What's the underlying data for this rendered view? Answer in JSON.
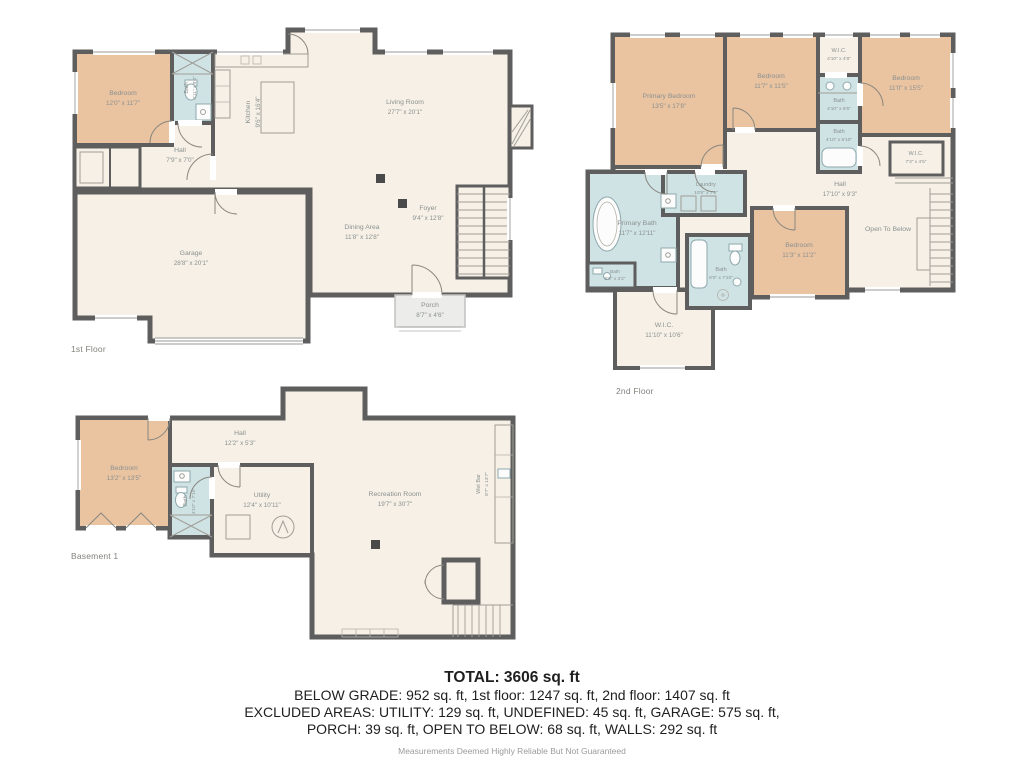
{
  "floors": {
    "first": {
      "label": "1st Floor",
      "rooms": {
        "bedroom": {
          "name": "Bedroom",
          "dims": "12'0\" x 11'7\""
        },
        "bath": {
          "name": "Bath",
          "dims": "4'11\" x 9'0\""
        },
        "kitchen": {
          "name": "Kitchen",
          "dims": "9'6\" x 16'4\""
        },
        "living": {
          "name": "Living Room",
          "dims": "27'7\" x 20'1\""
        },
        "hall": {
          "name": "Hall",
          "dims": "7'9\" x 7'0\""
        },
        "garage": {
          "name": "Garage",
          "dims": "28'8\" x 20'1\""
        },
        "dining": {
          "name": "Dining Area",
          "dims": "11'8\" x 12'8\""
        },
        "foyer": {
          "name": "Foyer",
          "dims": "9'4\" x 12'8\""
        },
        "porch": {
          "name": "Porch",
          "dims": "8'7\" x 4'6\""
        }
      }
    },
    "second": {
      "label": "2nd Floor",
      "rooms": {
        "primary_bedroom": {
          "name": "Primary Bedroom",
          "dims": "13'5\" x 17'8\""
        },
        "bedroom_mid": {
          "name": "Bedroom",
          "dims": "11'7\" x 11'5\""
        },
        "wic_top": {
          "name": "W.I.C.",
          "dims": "4'10\" x 4'8\""
        },
        "bath_top": {
          "name": "Bath",
          "dims": "4'10\" x 5'6\""
        },
        "bedroom_right": {
          "name": "Bedroom",
          "dims": "11'0\" x 15'5\""
        },
        "bath_mid": {
          "name": "Bath",
          "dims": "4'10\" x 5'10\""
        },
        "wic_right": {
          "name": "W.I.C.",
          "dims": "7'3\" x 4'5\""
        },
        "hall": {
          "name": "Hall",
          "dims": "17'10\" x 9'3\""
        },
        "primary_bath": {
          "name": "Primary Bath",
          "dims": "11'7\" x 12'11\""
        },
        "laundry": {
          "name": "Laundry",
          "dims": "10'8\" x 7'6\""
        },
        "bath_small": {
          "name": "Bath",
          "dims": "5'6\" x 3'2\""
        },
        "bath_center": {
          "name": "Bath",
          "dims": "8'0\" x 7'10\""
        },
        "bedroom_bottom": {
          "name": "Bedroom",
          "dims": "11'3\" x 11'2\""
        },
        "open_below": {
          "name": "Open To Below",
          "dims": ""
        },
        "wic_bottom": {
          "name": "W.I.C.",
          "dims": "11'10\" x 10'6\""
        }
      }
    },
    "basement": {
      "label": "Basement 1",
      "rooms": {
        "bedroom": {
          "name": "Bedroom",
          "dims": "13'2\" x 13'5\""
        },
        "hall": {
          "name": "Hall",
          "dims": "12'2\" x 5'3\""
        },
        "bath": {
          "name": "Bath",
          "dims": "4'10\" x 7'10\""
        },
        "utility": {
          "name": "Utility",
          "dims": "12'4\" x 10'11\""
        },
        "recreation": {
          "name": "Recreation Room",
          "dims": "19'7\" x 30'7\""
        },
        "wet_bar": {
          "name": "Wet Bar",
          "dims": "8'7\" x 13'7\""
        }
      }
    }
  },
  "summary": {
    "total": "TOTAL: 3606 sq. ft",
    "line1": "BELOW GRADE: 952 sq. ft, 1st floor: 1247 sq. ft, 2nd floor: 1407 sq. ft",
    "line2": "EXCLUDED AREAS: UTILITY: 129 sq. ft, UNDEFINED: 45 sq. ft, GARAGE: 575 sq. ft,",
    "line3": "PORCH: 39 sq. ft, OPEN TO BELOW: 68 sq. ft, WALLS: 292 sq. ft",
    "disclaimer": "Measurements Deemed Highly Reliable But Not Guaranteed"
  },
  "colors": {
    "wall": "#5e5e5e",
    "floor": "#f6f0e6",
    "bedroom": "#eac3a1",
    "bath": "#cfe3e5",
    "porch": "#ececea",
    "label": "#8b9190"
  }
}
